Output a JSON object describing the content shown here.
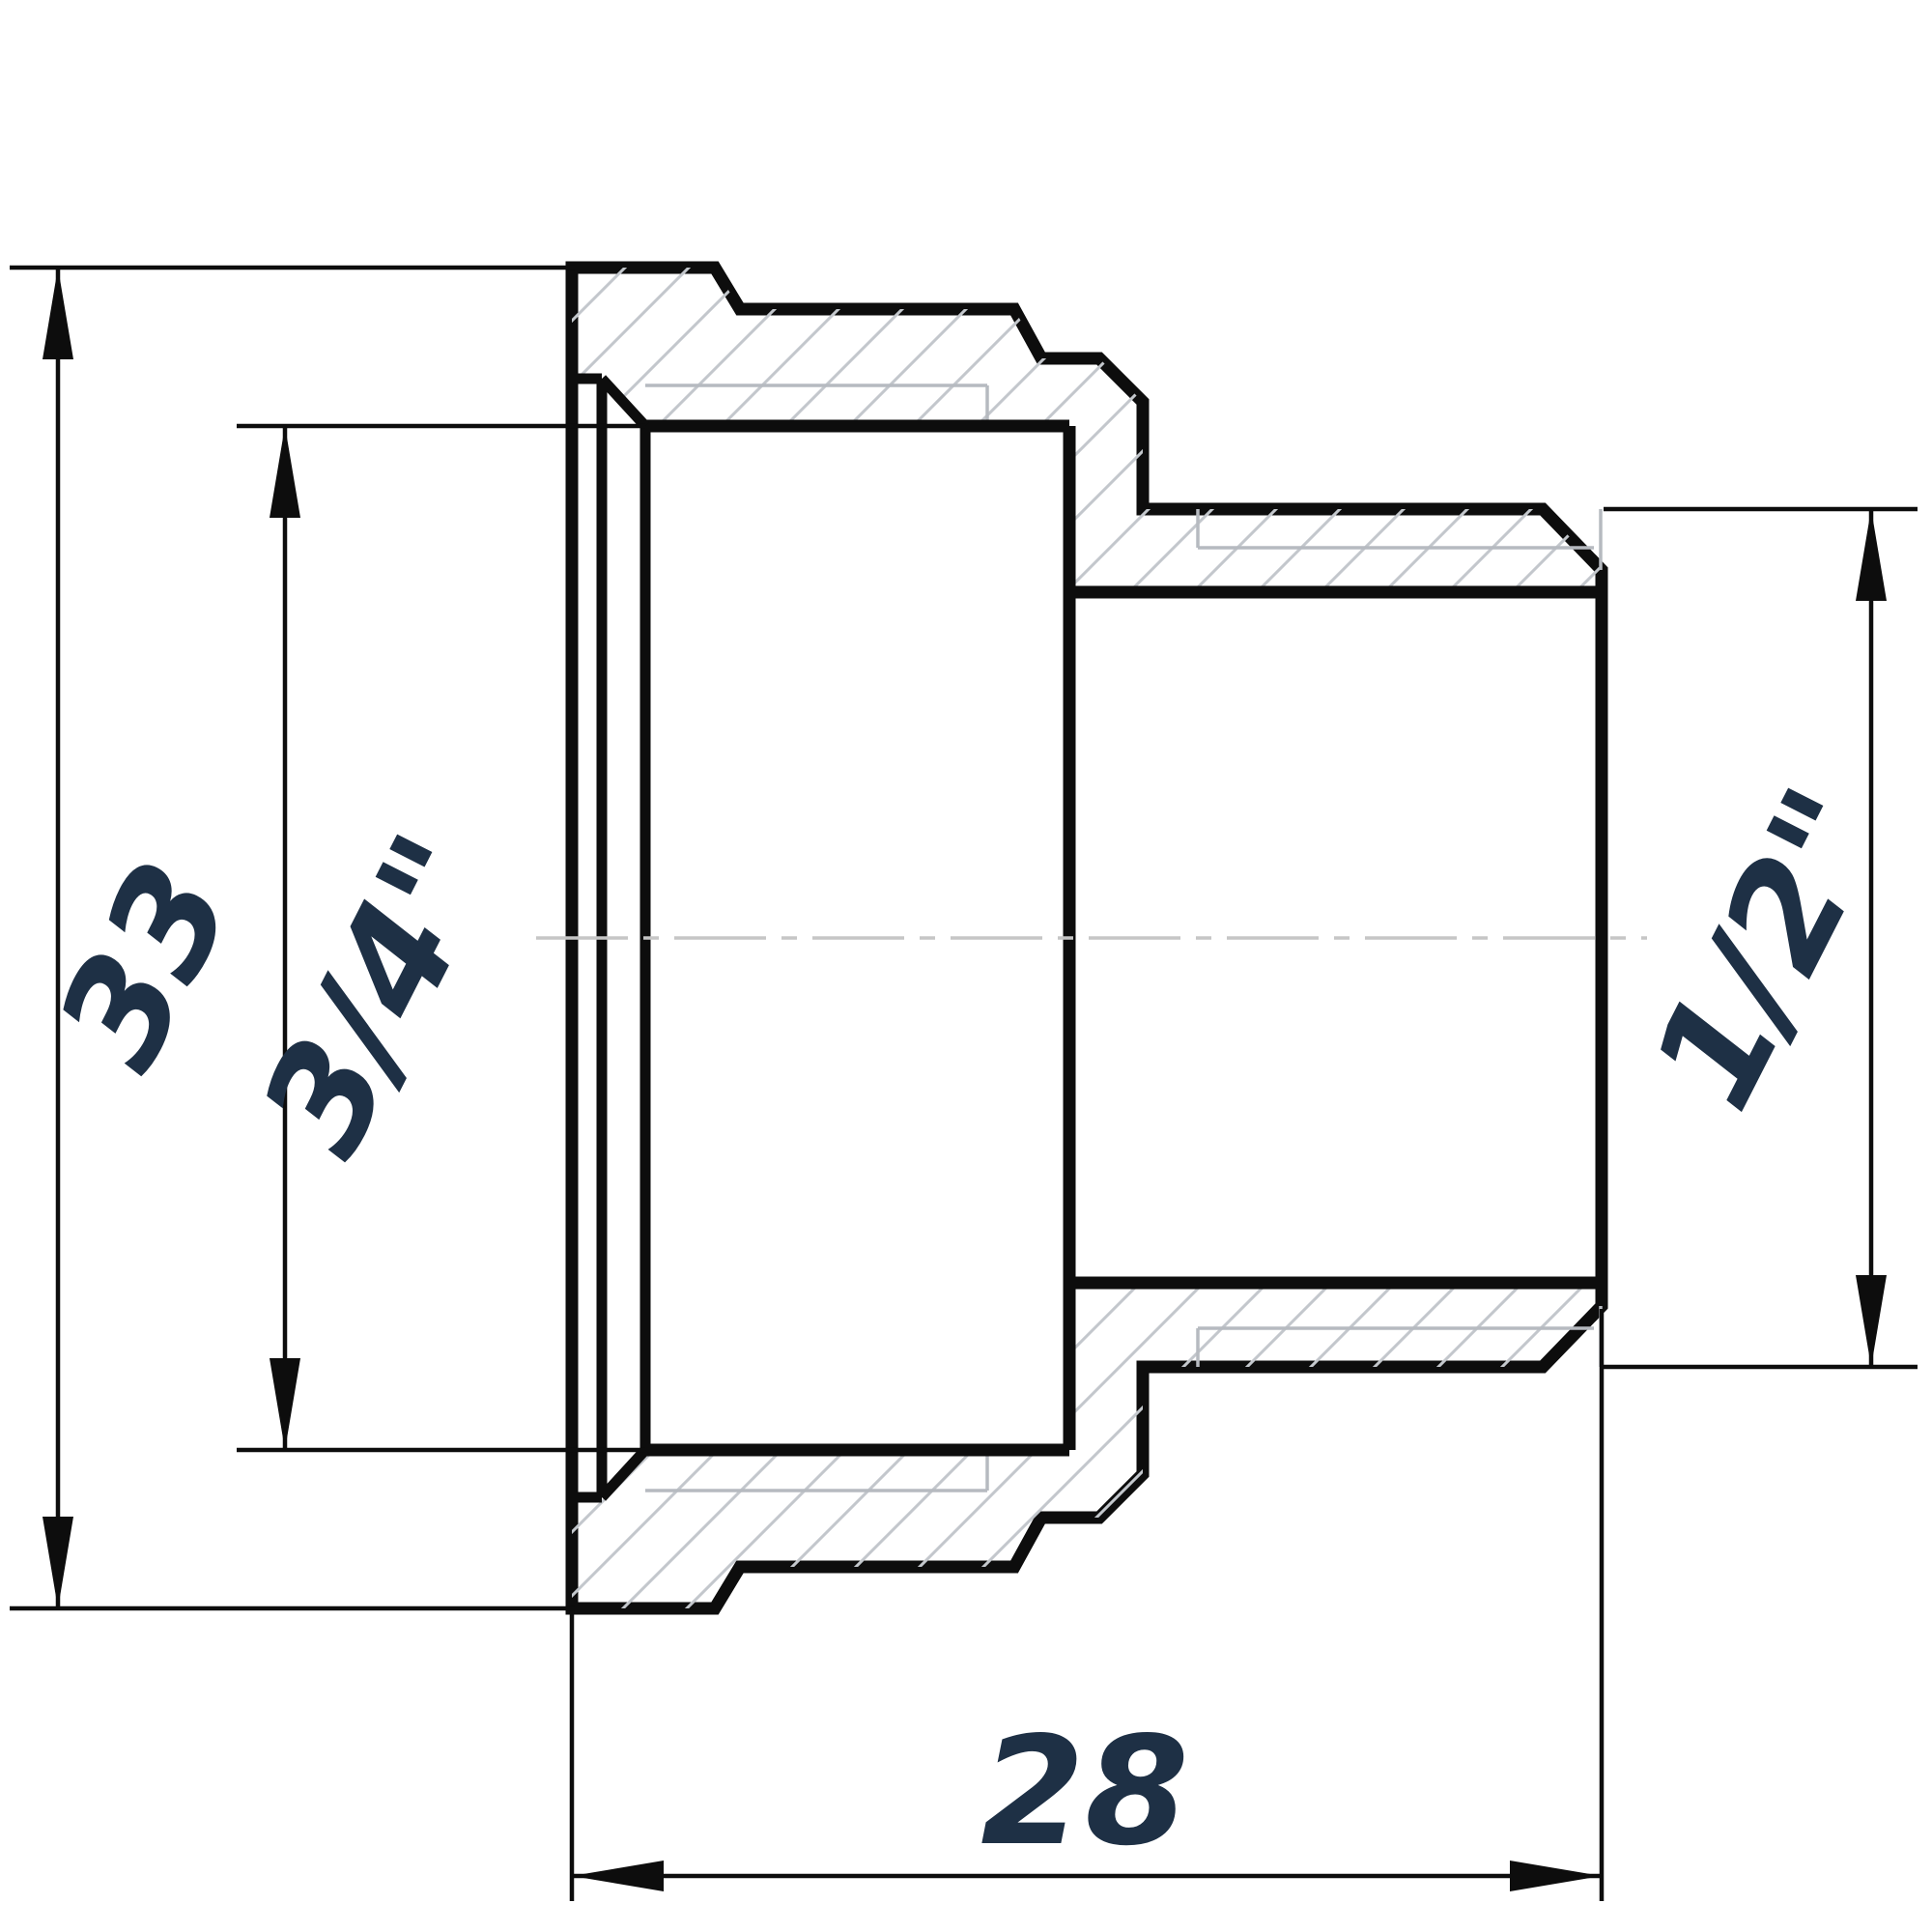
{
  "drawing": {
    "type": "technical-drawing",
    "subject": "Threaded reducing adapter fitting, sectional side view",
    "colors": {
      "line": "#0d0d0d",
      "label": "#1e3045",
      "hatch": "#c3c7cc",
      "thread_line": "#b6bac0",
      "center_line": "#c6c6c6",
      "background": "#ffffff"
    },
    "dimensions": {
      "overall_height": {
        "label": "33"
      },
      "socket_thread": {
        "label": "3/4\""
      },
      "spigot_thread": {
        "label": "1/2\""
      },
      "overall_length": {
        "label": "28"
      }
    }
  }
}
